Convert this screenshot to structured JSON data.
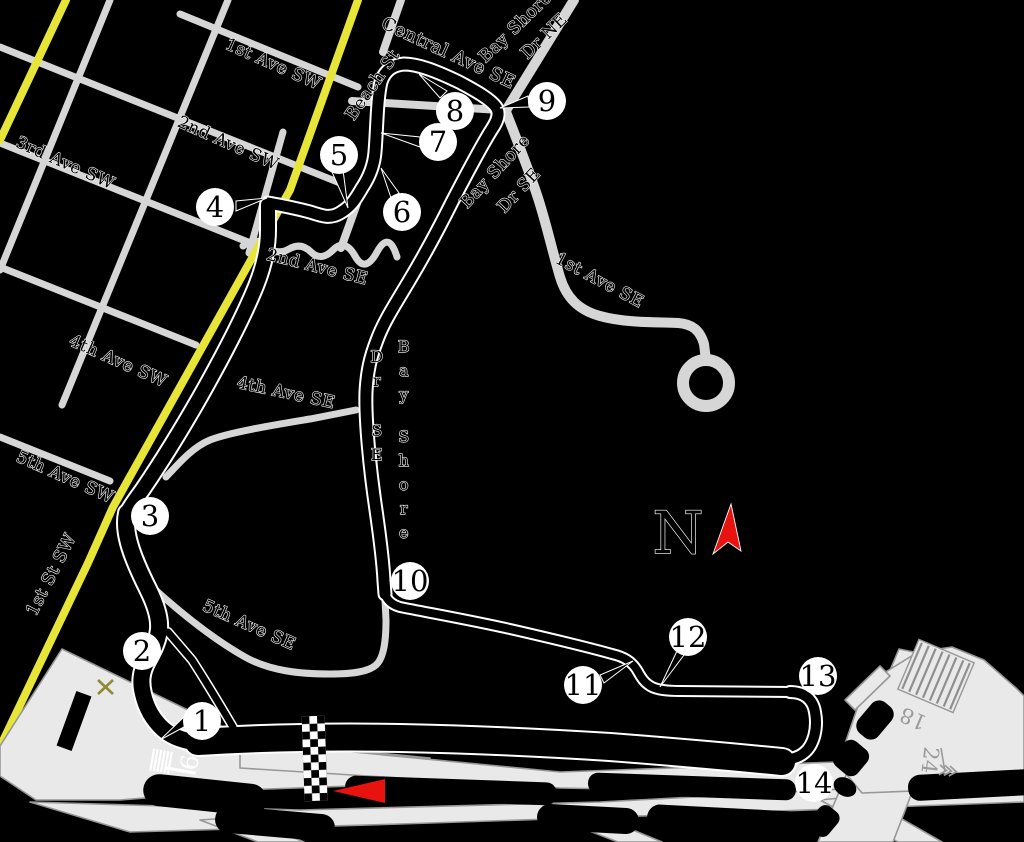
{
  "colors": {
    "background": "#000000",
    "street_gray": "#d6d6d6",
    "road_yellow": "#e8e539",
    "airport_fill": "#e9e9e9",
    "airport_stroke": "#979797",
    "track_black": "#000000",
    "track_casing": "#ffffff",
    "marker_red": "#e8130e",
    "closed_runway_x": "#8f8a33",
    "runway_text_gray": "#9a9a9a"
  },
  "labels": {
    "ave1sw": "1st Ave SW",
    "ave2sw": "2nd Ave SW",
    "ave3sw": "3rd Ave SW",
    "ave4sw": "4th Ave SW",
    "ave5sw": "5th Ave SW",
    "st1sw": "1st St SW",
    "ave2se": "2nd Ave SE",
    "ave4se": "4th Ave SE",
    "ave5se": "5th Ave SE",
    "central": "Central Ave SE",
    "beach": "Beach St",
    "bayshore_ne_1": "Bay Shore",
    "bayshore_ne_2": "Dr NE",
    "bayshore_se_1": "Bay Shore",
    "bayshore_se_2": "Dr SE",
    "bayshore_v_1": "Bay Shore",
    "bayshore_v_2": "Dr SE",
    "ave1se": "1st Ave SE",
    "compass": "N",
    "runway9": "9",
    "runway18": "18",
    "runway24": "24"
  },
  "turns": [
    "1",
    "2",
    "3",
    "4",
    "5",
    "6",
    "7",
    "8",
    "9",
    "10",
    "11",
    "12",
    "13",
    "14"
  ]
}
